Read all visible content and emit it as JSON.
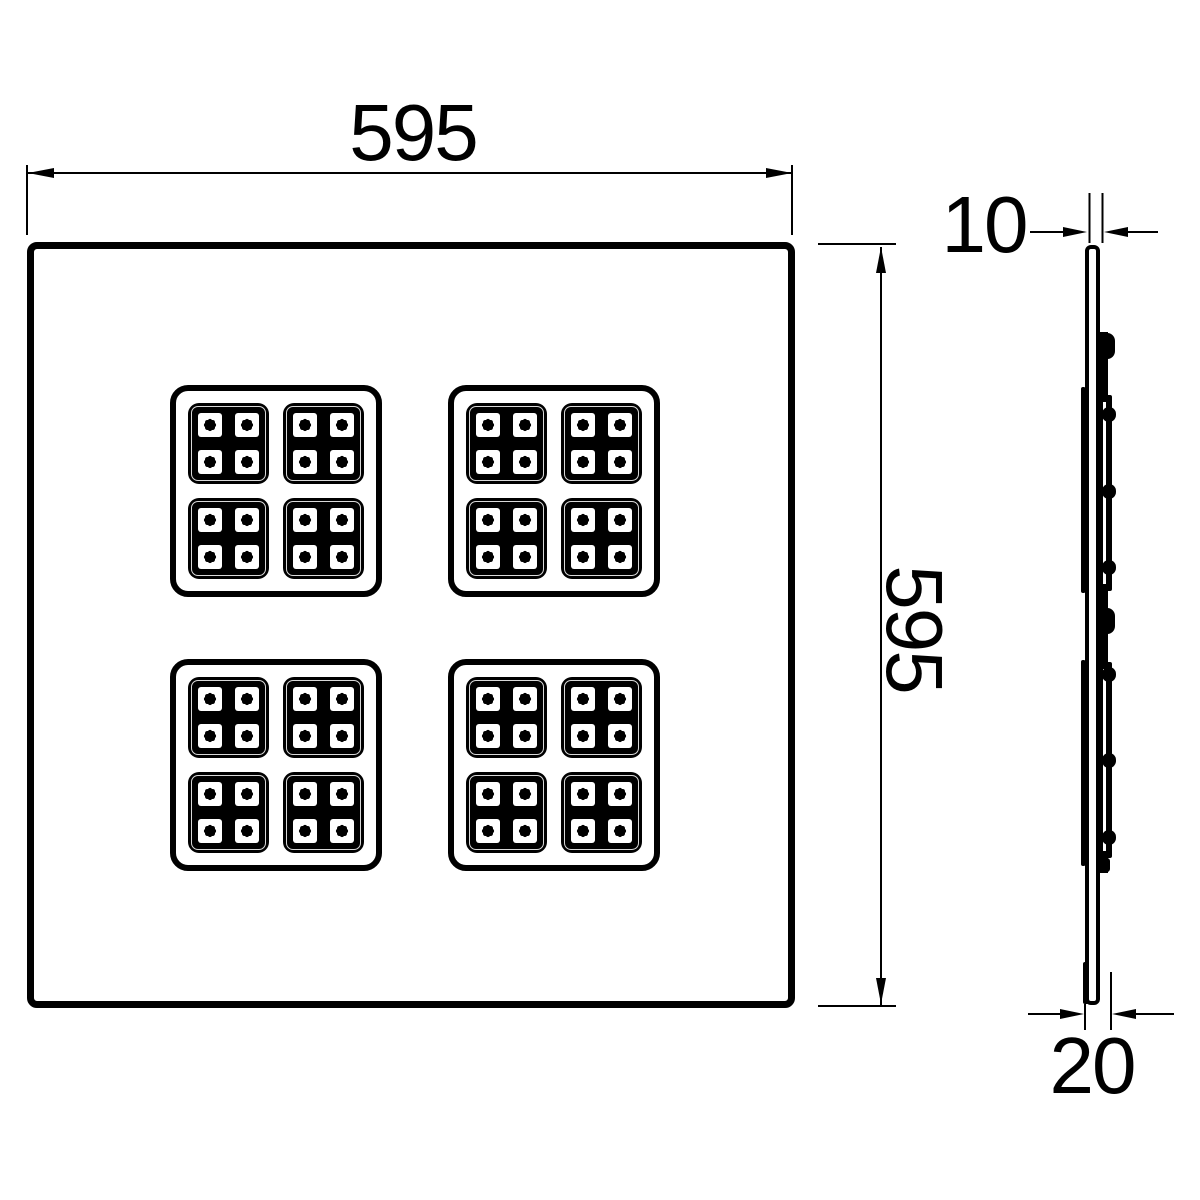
{
  "dimensions": {
    "width": {
      "value": "595"
    },
    "height": {
      "value": "595"
    },
    "thickness": {
      "value": "10"
    },
    "depth": {
      "value": "20"
    }
  },
  "front_view": {
    "cluster_count": 4,
    "modules_per_cluster": 4,
    "leds_per_module": 4
  },
  "colors": {
    "line": "#000000",
    "background": "#ffffff"
  }
}
